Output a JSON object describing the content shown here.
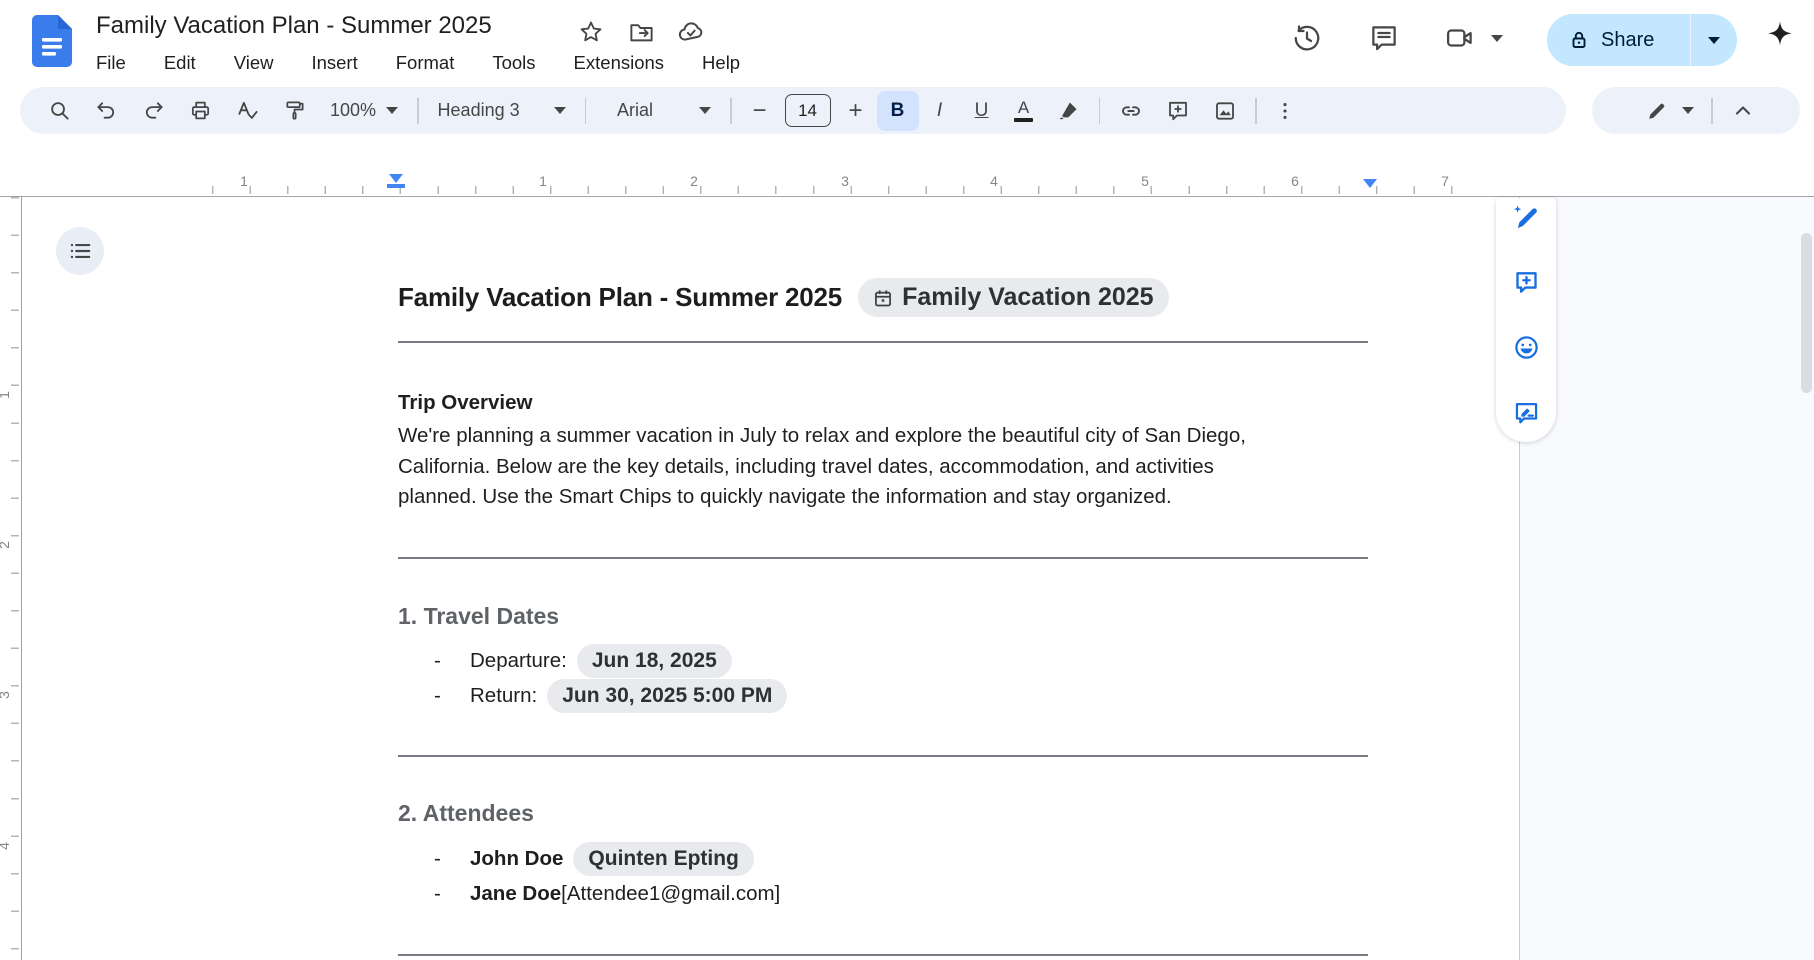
{
  "header": {
    "title": "Family Vacation Plan - Summer 2025",
    "menus": [
      "File",
      "Edit",
      "View",
      "Insert",
      "Format",
      "Tools",
      "Extensions",
      "Help"
    ],
    "share_label": "Share"
  },
  "toolbar": {
    "zoom": "100%",
    "style": "Heading 3",
    "font": "Arial",
    "font_size": "14",
    "minus": "−",
    "plus": "+",
    "bold": "B",
    "italic": "I",
    "underline": "U",
    "text_color_letter": "A"
  },
  "ruler": {
    "h": [
      "1",
      "1",
      "2",
      "3",
      "4",
      "5",
      "6",
      "7"
    ],
    "v": [
      "1",
      "2",
      "3",
      "4"
    ]
  },
  "doc": {
    "title": "Family Vacation Plan - Summer 2025",
    "title_chip": "Family Vacation 2025",
    "overview_heading": "Trip Overview",
    "overview_lines": [
      "We're planning a summer vacation in July to relax and explore the beautiful city of San Diego,",
      "California. Below are the key details, including travel dates, accommodation, and activities",
      "planned. Use the Smart Chips to quickly navigate the information and stay organized."
    ],
    "travel": {
      "heading": "1. Travel Dates",
      "items": [
        {
          "bullet": "-",
          "label": "Departure:",
          "chip": "Jun 18, 2025"
        },
        {
          "bullet": "-",
          "label": "Return:",
          "chip": "Jun 30, 2025 5:00 PM"
        }
      ]
    },
    "attendees": {
      "heading": "2. Attendees",
      "items": [
        {
          "bullet": "-",
          "name": "John Doe",
          "chip": "Quinten Epting"
        },
        {
          "bullet": "-",
          "name": "Jane Doe",
          "suffix": "[Attendee1@gmail.com]"
        }
      ]
    }
  },
  "colors": {
    "accent_blue": "#0b57d0",
    "share_bg": "#c2e7ff",
    "toolbar_bg": "#edf2fa",
    "active_btn_bg": "#d3e3fd",
    "chip_bg": "#e9eaee",
    "ruler_marker_blue": "#4285f4",
    "section_heading_gray": "#5f6368"
  }
}
